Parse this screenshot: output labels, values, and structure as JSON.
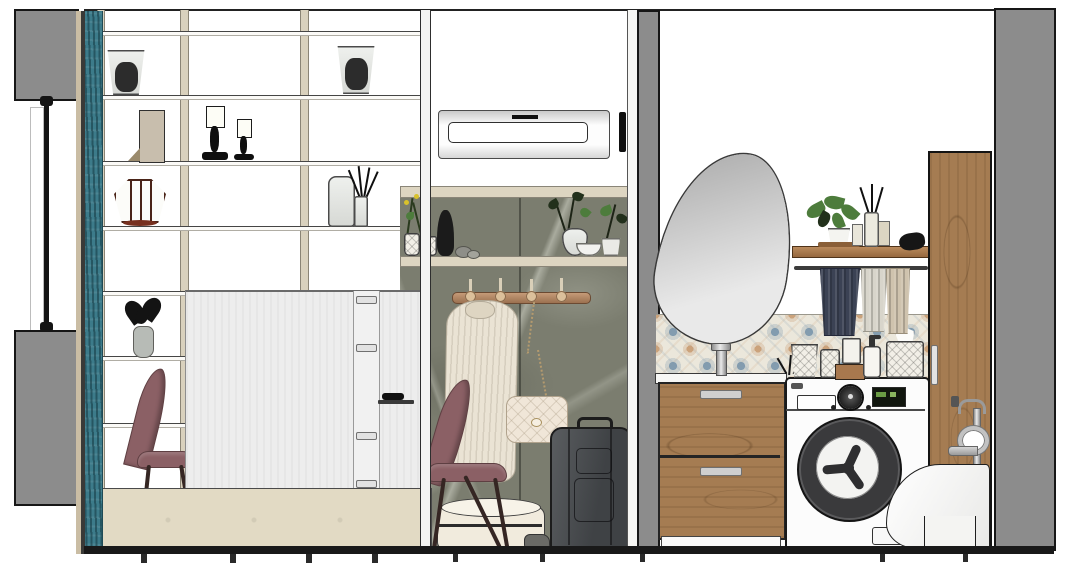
{
  "palette": {
    "wall_gray": "#8c8c8c",
    "outline": "#1d1d1d",
    "curtain_teal": "#3c7b8a",
    "frame_cream": "#d9d1bd",
    "shelf_cream": "#ddd5c1",
    "bench_beige": "#e2dac4",
    "panel_white": "#ededed",
    "marble_green": "#7b7d6f",
    "rack_wood": "#b08a68",
    "coat_cream": "#eae3d4",
    "bag_cream": "#f0e6d8",
    "suitcase_gray": "#4e5154",
    "chair_mauve": "#8b6065",
    "chair_leg": "#352623",
    "tile_base": "#ebe7db",
    "tile_blue": "#7d98ad",
    "tile_tan": "#c99f77",
    "wood_oak": "#a57c52",
    "towel_navy": "#3b4254",
    "towel_gray": "#d8d5cb",
    "towel_tan": "#cfc3ae",
    "washer_ring": "#3a3a3c",
    "display_green": "#6a9b44",
    "plant_green": "#4d7c3c",
    "mirror_gray": "#c0c0c0",
    "chrome": "#c6c6c6",
    "floor_black": "#191919"
  },
  "scene": {
    "type": "interior-elevation-rendering",
    "sections": [
      {
        "id": "left-wall",
        "objects": [
          "wall-section-top",
          "window-pole",
          "wall-section-bottom",
          "curtain-panel"
        ]
      },
      {
        "id": "living-area",
        "objects": [
          "shelving-unit",
          "glass-planters",
          "book-stand",
          "candlesticks",
          "wire-lantern",
          "vase-with-black-flowers",
          "glass-jar",
          "reed-diffuser",
          "dining-chairs",
          "white-cabinet",
          "display-niche",
          "sideboard-bench"
        ]
      },
      {
        "id": "hallway",
        "objects": [
          "vent-panel",
          "marble-wall",
          "display-shelves",
          "flower-branch",
          "black-bottle-vase",
          "pebbles",
          "potted-plants",
          "coat-rack",
          "hanging-coat",
          "chain-strap-bag",
          "storage-hat-boxes",
          "suitcase"
        ]
      },
      {
        "id": "bathroom-laundry",
        "objects": [
          "pebble-mirror",
          "patterned-tile-backsplash",
          "basin-faucet",
          "wood-vanity-drawers",
          "washing-machine",
          "storage-baskets",
          "soap-dispenser",
          "tissue-basket",
          "wall-shelf",
          "potted-plant",
          "reed-diffuser",
          "perfume-bottles",
          "towel-rail",
          "towels",
          "tall-wood-cabinet",
          "bidet-faucet",
          "wall-hung-toilet"
        ]
      }
    ]
  }
}
